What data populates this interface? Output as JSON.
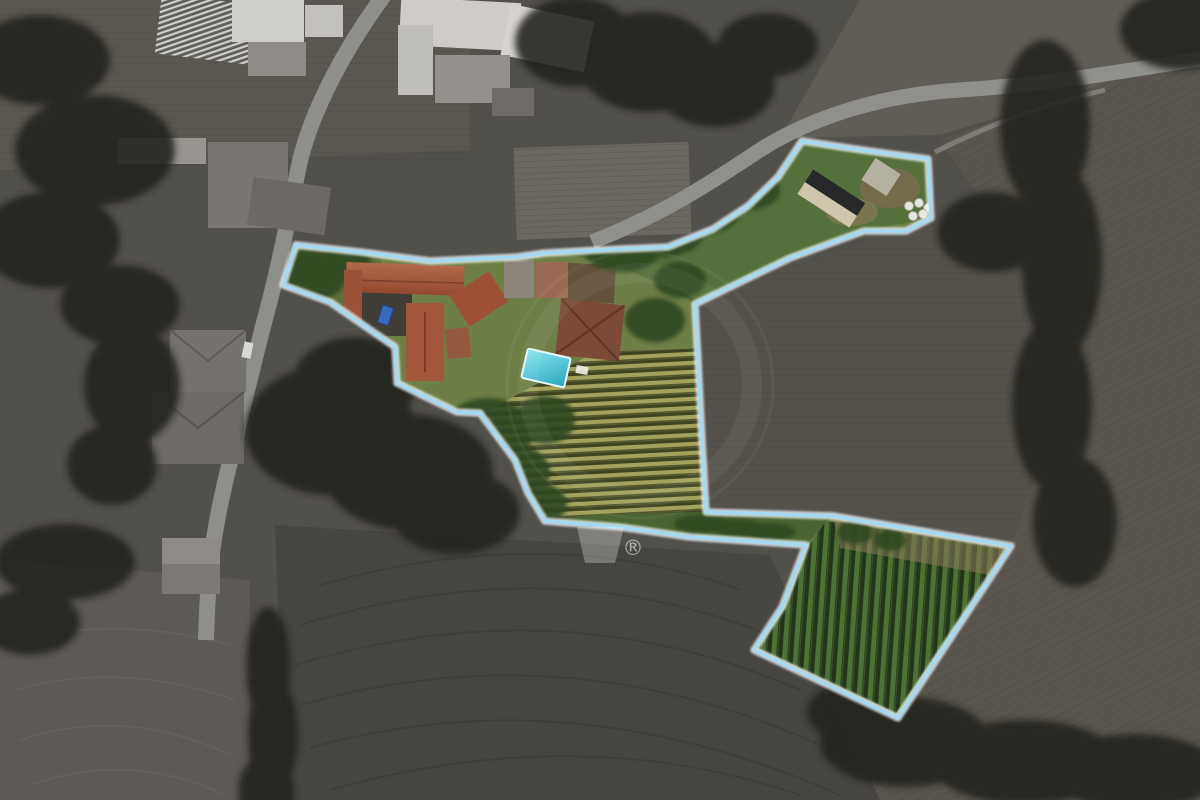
{
  "image": {
    "kind": "aerial-drone-photo-of-rural-property-for-sale",
    "style": "surroundings desaturated to grayscale; property interior in full color; light blue plot boundary overlay",
    "watermark": {
      "registered_symbol": "®"
    },
    "boundary": {
      "line_color": "#a6d9f2",
      "halo_color": "#f2f9ff"
    },
    "property_features": [
      "farmhouse complex with terracotta tile roofs around a dark courtyard",
      "blue car parked in courtyard",
      "turquoise swimming pool with white lounger",
      "lawn and garden with bushes",
      "central vineyard with horizontal rows",
      "upper-right paddock with dark-roofed barn, ruined shed and white hay bales",
      "narrow hedge corridor connecting to lower vineyard parcel",
      "lower vineyard parcel with dense vertical green rows"
    ],
    "surroundings_features": [
      "village houses with gray roofs",
      "greenhouse with striped roof",
      "white farm buildings",
      "curving asphalt roads and dirt track",
      "plowed gray fields with furrow lines",
      "dark tree lines and hedgerows"
    ],
    "colors": {
      "pool": "#35b9cc",
      "terracotta_roof": "#a2583c",
      "brown_hip_roof": "#7c4a36",
      "vineyard_row_light": "#a2a25c",
      "vineyard_row_dark": "#3e4420",
      "lower_vineyard_green": "#4e7134",
      "lawn": "#6e7f46",
      "outside_field_gray": "#54514b",
      "road_gray": "#8e8e8a"
    }
  }
}
